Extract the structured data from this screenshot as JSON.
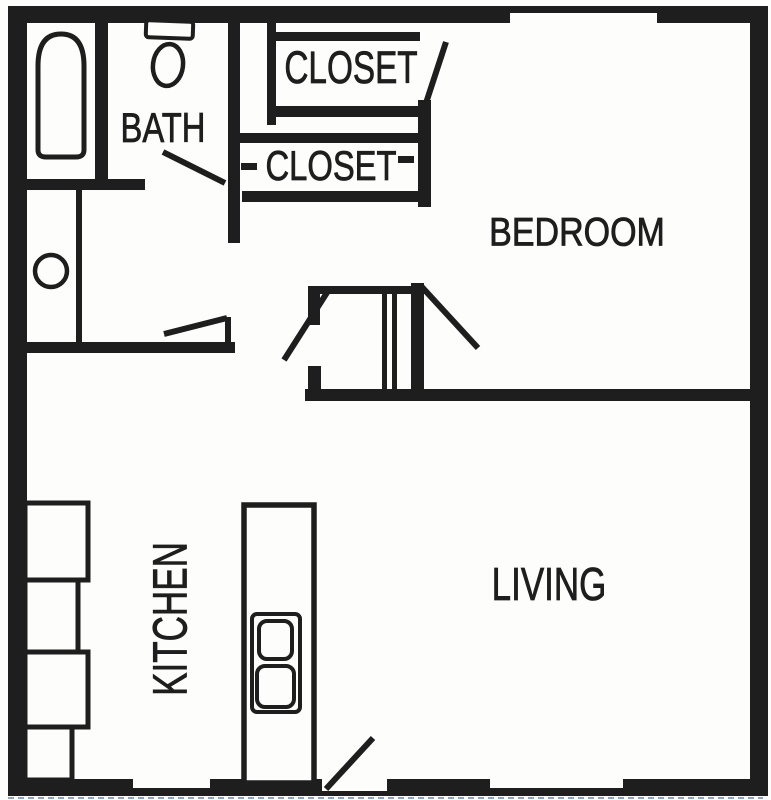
{
  "diagram_type": "apartment-floor-plan",
  "labels": {
    "bath": "BATH",
    "closet_upper": "CLOSET",
    "closet_lower": "CLOSET",
    "bedroom": "BEDROOM",
    "kitchen": "KITCHEN",
    "living": "LIVING"
  },
  "colors": {
    "ink": "#1e1e1e",
    "paper": "#fdfdfc",
    "scan_edge": "#8fa3c0"
  },
  "fixtures": [
    "bathtub",
    "toilet",
    "vanity-sink",
    "hall-closet-shelves",
    "utility-closet",
    "kitchen-counter-run",
    "kitchen-island",
    "range-burners",
    "entry-door",
    "windows"
  ]
}
